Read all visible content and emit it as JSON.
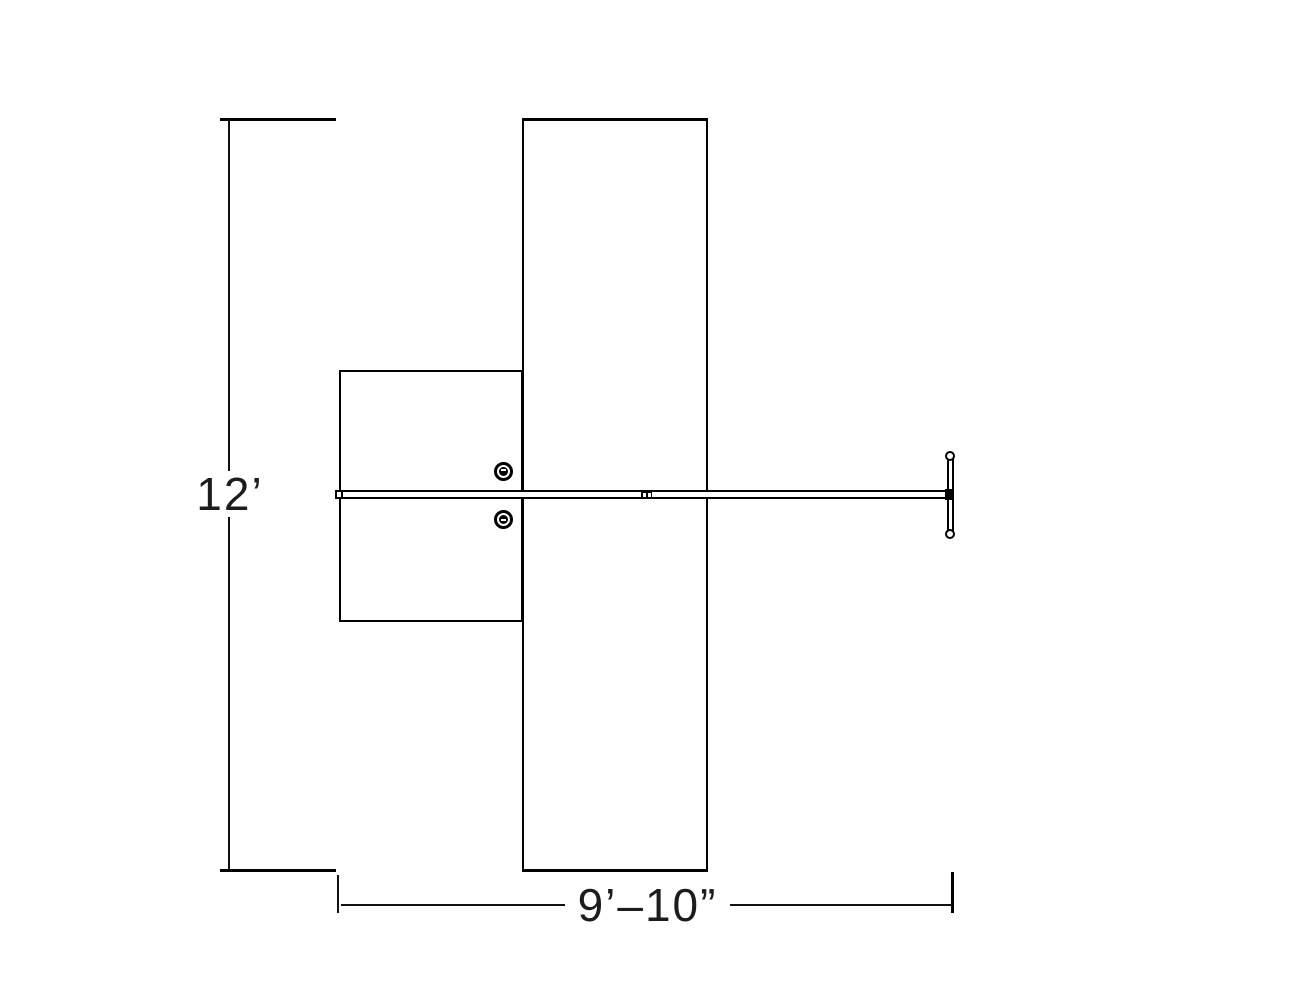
{
  "drawing": {
    "type": "cad-plan-view-technical-drawing",
    "background_color": "#ffffff",
    "line_color": "#000000",
    "text_color": "#1c1c1c",
    "vertical_dimension": {
      "label": "12’"
    },
    "horizontal_dimension": {
      "label": "9’–10”"
    }
  }
}
